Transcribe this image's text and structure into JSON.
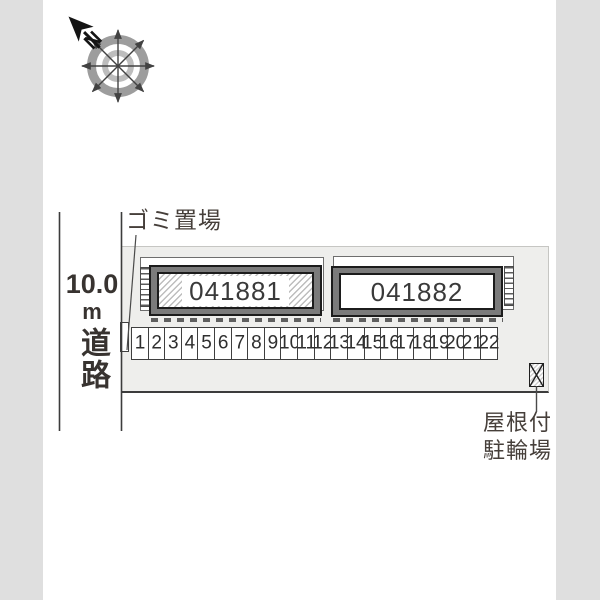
{
  "compass": {
    "north_label": "N"
  },
  "site": {
    "garbage_label": "ゴミ置場",
    "road": {
      "distance": "10.0",
      "unit": "m",
      "name": "道路"
    },
    "bike_parking": {
      "line1": "屋根付",
      "line2": "駐輪場"
    }
  },
  "buildings": [
    {
      "id": "041881",
      "hatched": true
    },
    {
      "id": "041882",
      "hatched": false
    }
  ],
  "parking": {
    "stalls": [
      "1",
      "2",
      "3",
      "4",
      "5",
      "6",
      "7",
      "8",
      "9",
      "10",
      "11",
      "12",
      "13",
      "14",
      "15",
      "16",
      "17",
      "18",
      "19",
      "20",
      "21",
      "22"
    ]
  },
  "colors": {
    "edge_strip": "#dfdfdf",
    "site_fill": "#eeeeec",
    "building_fill": "#7b7b7b",
    "outline_dark": "#1c1c1c",
    "boundary_line": "#3c3c3c",
    "text": "#463f3a"
  }
}
